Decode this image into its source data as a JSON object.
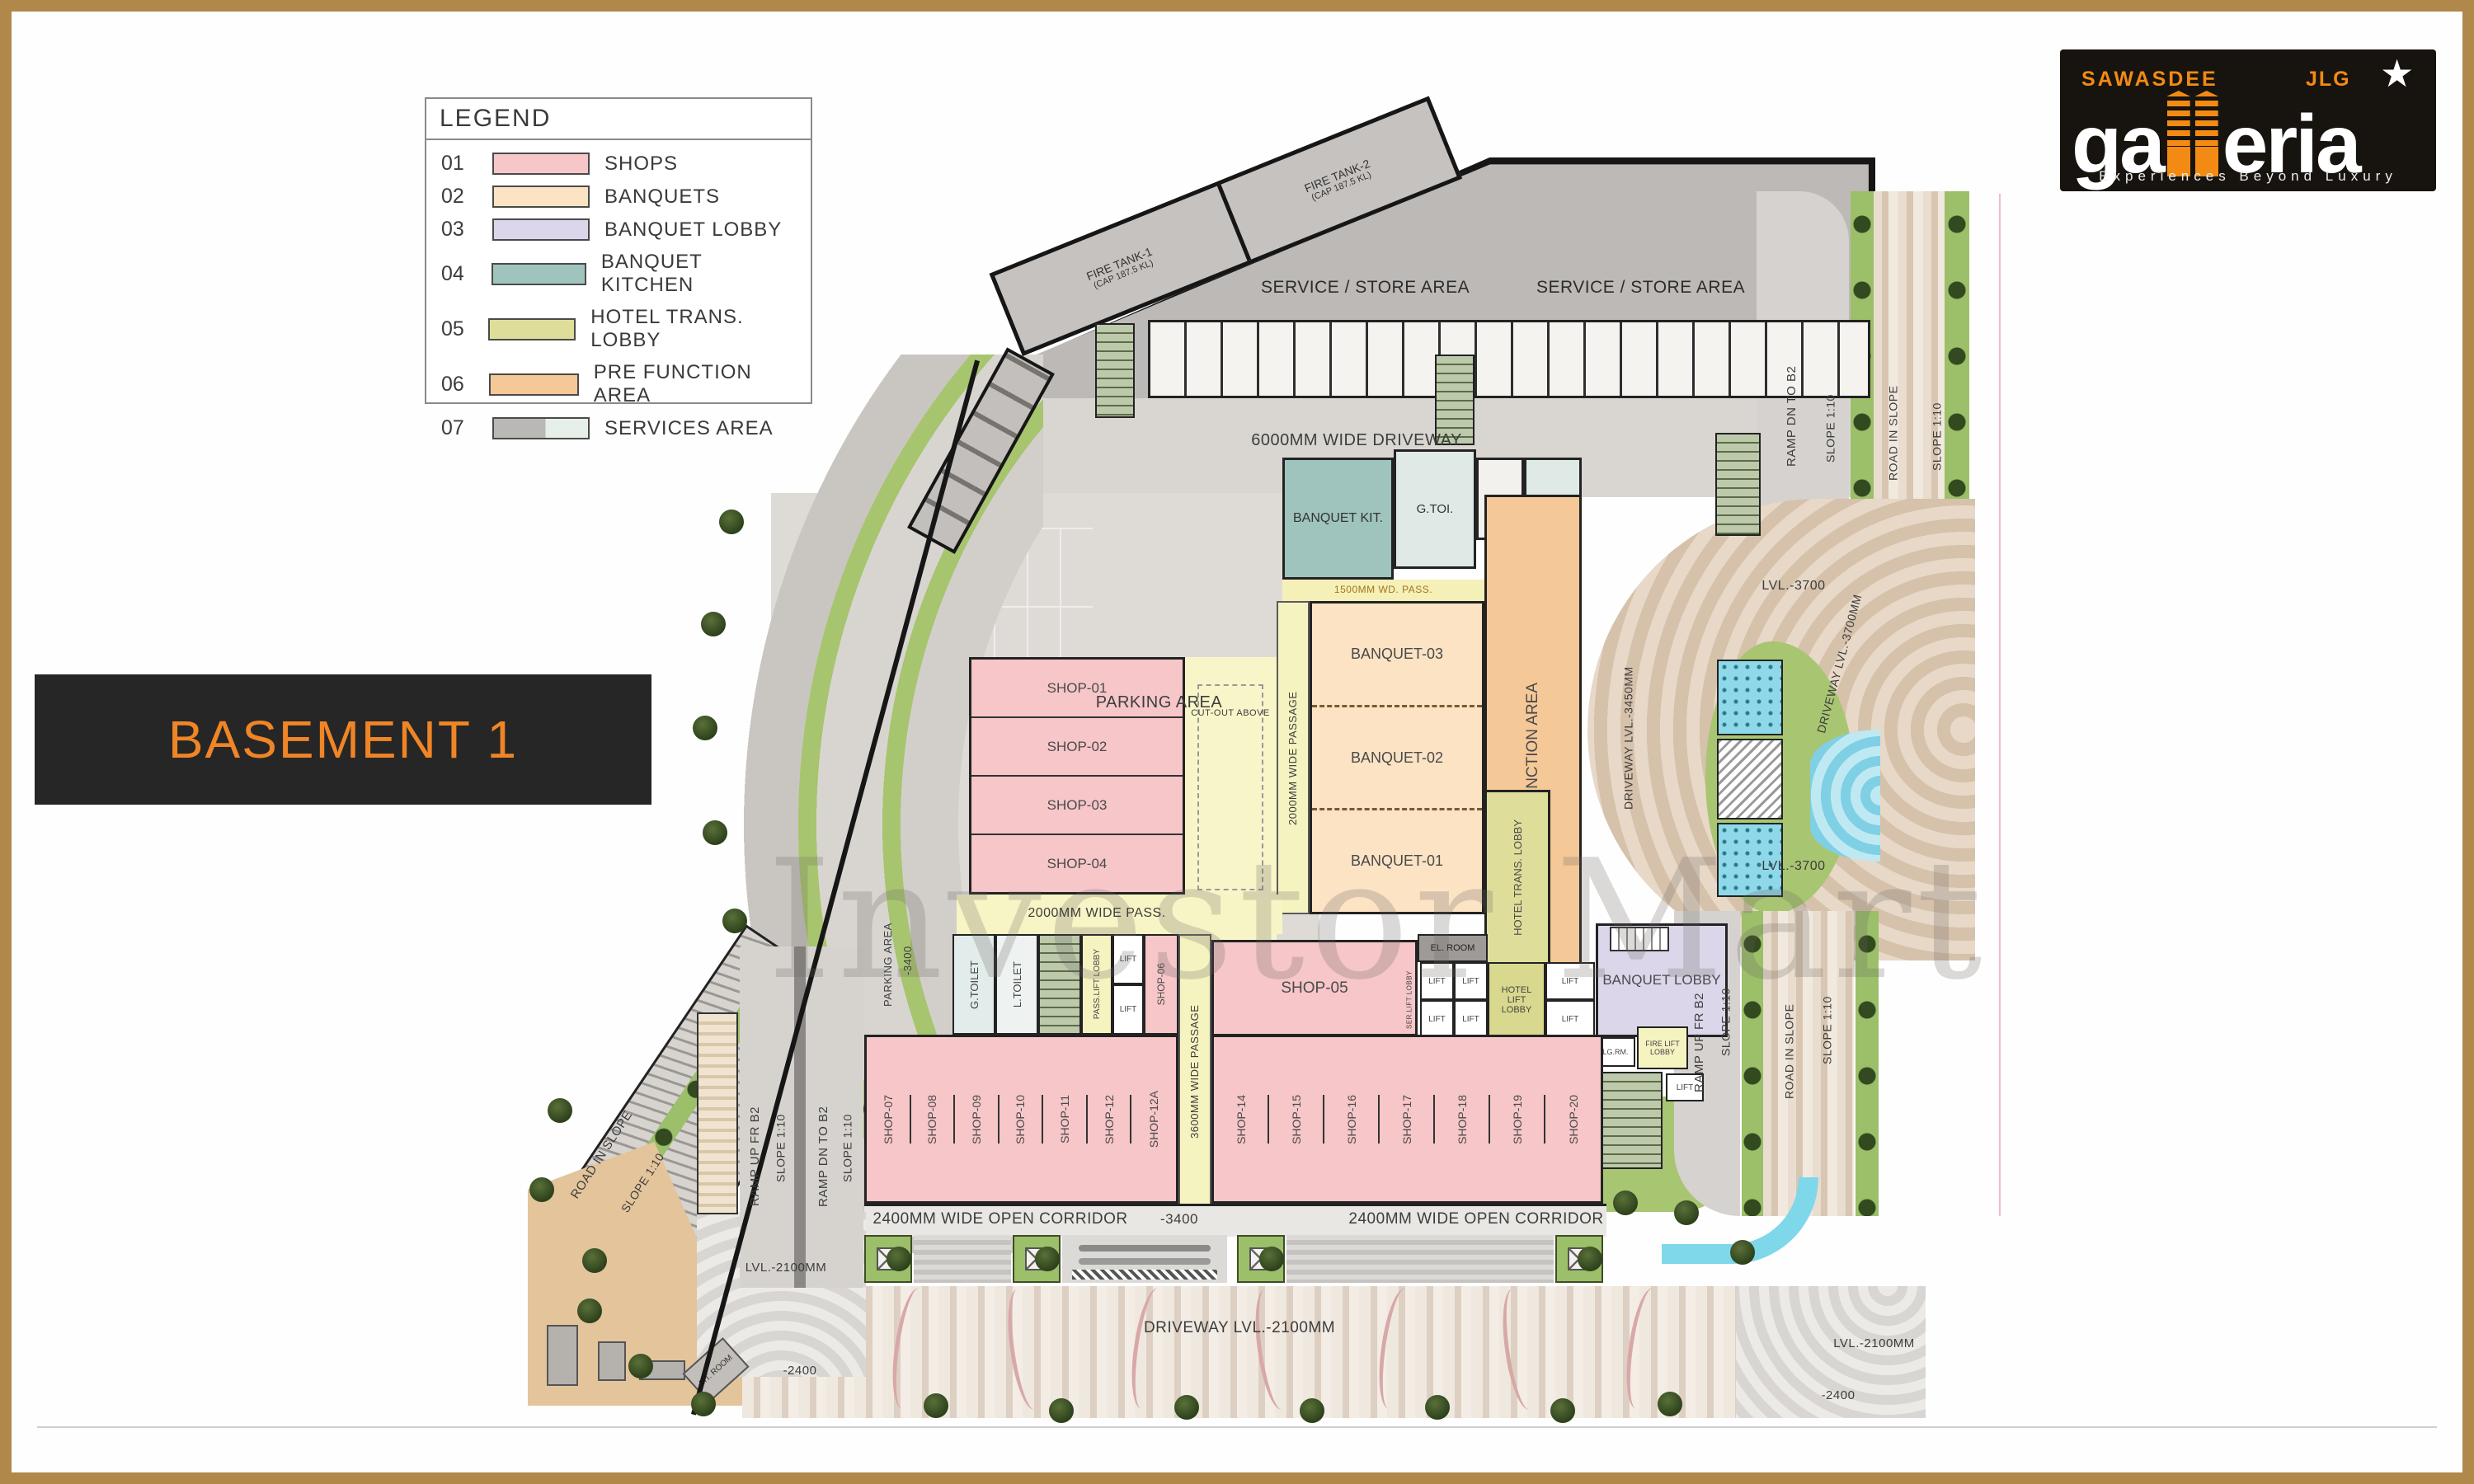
{
  "title": "BASEMENT 1",
  "watermark": "Investor Mart",
  "brand": {
    "top_left": "SAWASDEE",
    "top_right": "JLG",
    "main_left": "ga",
    "main_right": "eria",
    "tagline": "Experiences Beyond Luxury",
    "accent_color": "#f28a14",
    "frame_color": "#b0884a"
  },
  "legend": {
    "title": "LEGEND",
    "items": [
      {
        "code": "01",
        "label": "SHOPS",
        "color": "#f6c6c8"
      },
      {
        "code": "02",
        "label": "BANQUETS",
        "color": "#fbe3c4"
      },
      {
        "code": "03",
        "label": "BANQUET LOBBY",
        "color": "#dcd6ea"
      },
      {
        "code": "04",
        "label": "BANQUET KITCHEN",
        "color": "#9fc4bd"
      },
      {
        "code": "05",
        "label": "HOTEL TRANS. LOBBY",
        "color": "#dede9a"
      },
      {
        "code": "06",
        "label": "PRE FUNCTION AREA",
        "color": "#f5c897"
      },
      {
        "code": "07",
        "label": "SERVICES AREA",
        "color": "#bdb9b6"
      }
    ]
  },
  "shops": {
    "top": [
      "SHOP-01",
      "SHOP-02",
      "SHOP-03",
      "SHOP-04"
    ],
    "s05": "SHOP-05",
    "s06": "SHOP-06",
    "left": [
      "SHOP-07",
      "SHOP-08",
      "SHOP-09",
      "SHOP-10",
      "SHOP-11",
      "SHOP-12",
      "SHOP-12A"
    ],
    "right": [
      "SHOP-14",
      "SHOP-15",
      "SHOP-16",
      "SHOP-17",
      "SHOP-18",
      "SHOP-19",
      "SHOP-20"
    ]
  },
  "labels": {
    "fire_tank_1": "FIRE TANK-1",
    "fire_tank_1_cap": "(CAP 187.5 KL)",
    "fire_tank_2": "FIRE TANK-2",
    "fire_tank_2_cap": "(CAP 187.5 KL)",
    "service_store": "SERVICE / STORE AREA",
    "driveway_6000": "6000MM WIDE DRIVEWAY",
    "parking_area": "PARKING AREA",
    "minus_3400": "-3400",
    "banquet_kit": "BANQUET KIT.",
    "g_toi": "G.TOI.",
    "h_toi": "H.TOI.",
    "l_toi": "L.TOI.",
    "pass_1500": "1500MM WD. PASS.",
    "banquet_03": "BANQUET-03",
    "banquet_02": "BANQUET-02",
    "banquet_01": "BANQUET-01",
    "pre_function": "PRE FUNCTION AREA",
    "hotel_trans": "HOTEL TRANS. LOBBY",
    "passage_2000_v": "2000MM WIDE PASSAGE",
    "pass_2000_h": "2000MM WIDE PASS.",
    "passage_3600": "3600MM WIDE PASSAGE",
    "cutout_above": "CUT-OUT ABOVE",
    "g_toilet": "G.TOILET",
    "l_toilet": "L.TOILET",
    "pass_lift_lobby": "PASS.LIFT LOBBY",
    "ser_lift_lobby": "SER.LIFT LOBBY",
    "lift": "LIFT",
    "el_room": "EL. ROOM",
    "hotel_lift_lobby": "HOTEL LIFT LOBBY",
    "banquet_lobby": "BANQUET LOBBY",
    "lg_rm": "LG.RM.",
    "fire_lift_lobby": "FIRE LIFT LOBBY",
    "corridor_2400": "2400MM WIDE OPEN CORRIDOR",
    "driveway_2100": "DRIVEWAY LVL.-2100MM",
    "lvl_2100": "LVL.-2100MM",
    "minus_2400": "-2400",
    "ramp_up_fr_b2": "RAMP UP FR B2",
    "ramp_dn_to_b2": "RAMP DN TO B2",
    "slope_110": "SLOPE 1:10",
    "road_in_slope": "ROAD IN SLOPE",
    "lvl_3700": "LVL.-3700",
    "driveway_3450": "DRIVEWAY LVL.-3450MM",
    "driveway_3700": "DRIVEWAY LVL.-3700MM",
    "mt_room": "MT. ROOM"
  }
}
